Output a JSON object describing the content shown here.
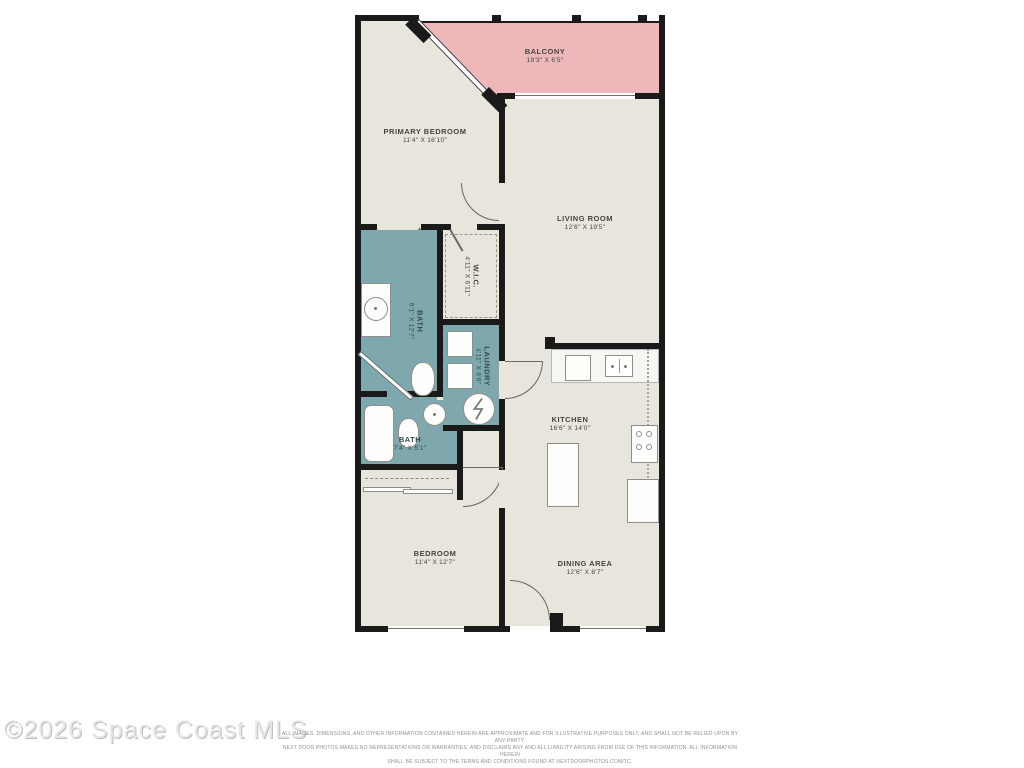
{
  "watermark": "©2026 Space Coast MLS",
  "disclaimer": {
    "line1": "ALL IMAGES, DIMENSIONS, AND OTHER INFORMATION CONTAINED HEREIN ARE APPROXIMATE AND FOR ILLUSTRATIVE PURPOSES ONLY, AND SHALL NOT BE RELIED UPON BY ANY PARTY.",
    "line2": "NEXT DOOR PHOTOS MAKES NO REPRESENTATIONS OR WARRANTIES, AND DISCLAIMS ANY AND ALL LIABILITY ARISING FROM USE OF THIS INFORMATION. ALL INFORMATION HEREIN",
    "line3": "SHALL BE SUBJECT TO THE TERMS AND CONDITIONS FOUND AT NEXTDOORPHOTOS.COM/TC."
  },
  "floorplan": {
    "rooms": {
      "balcony": {
        "name": "BALCONY",
        "dims": "19'3\" X 6'5\""
      },
      "primary_bedroom": {
        "name": "PRIMARY BEDROOM",
        "dims": "11'4\" X 16'10\""
      },
      "living_room": {
        "name": "LIVING ROOM",
        "dims": "12'6\" X 19'5\""
      },
      "wic": {
        "name": "W.I.C.",
        "dims": "4'11\" X 6'11\""
      },
      "bath_primary": {
        "name": "BATH",
        "dims": "6'1\" X 12'7\""
      },
      "laundry": {
        "name": "LAUNDRY",
        "dims": "4'11\" X 8'0\""
      },
      "bath_second": {
        "name": "BATH",
        "dims": "7'4\" X 5'1\""
      },
      "kitchen": {
        "name": "KITCHEN",
        "dims": "16'6\" X 14'0\""
      },
      "bedroom": {
        "name": "BEDROOM",
        "dims": "11'4\" X 12'7\""
      },
      "dining_area": {
        "name": "DINING AREA",
        "dims": "12'6\" X 8'7\""
      }
    },
    "colors": {
      "wall": "#1a1a1a",
      "floor": "#e7e5dc",
      "balcony_fill": "#eeb8bb",
      "wet_room_fill": "#7fa8ae",
      "label_text": "#45453f",
      "watermark_text": "#e7e7e4"
    }
  }
}
